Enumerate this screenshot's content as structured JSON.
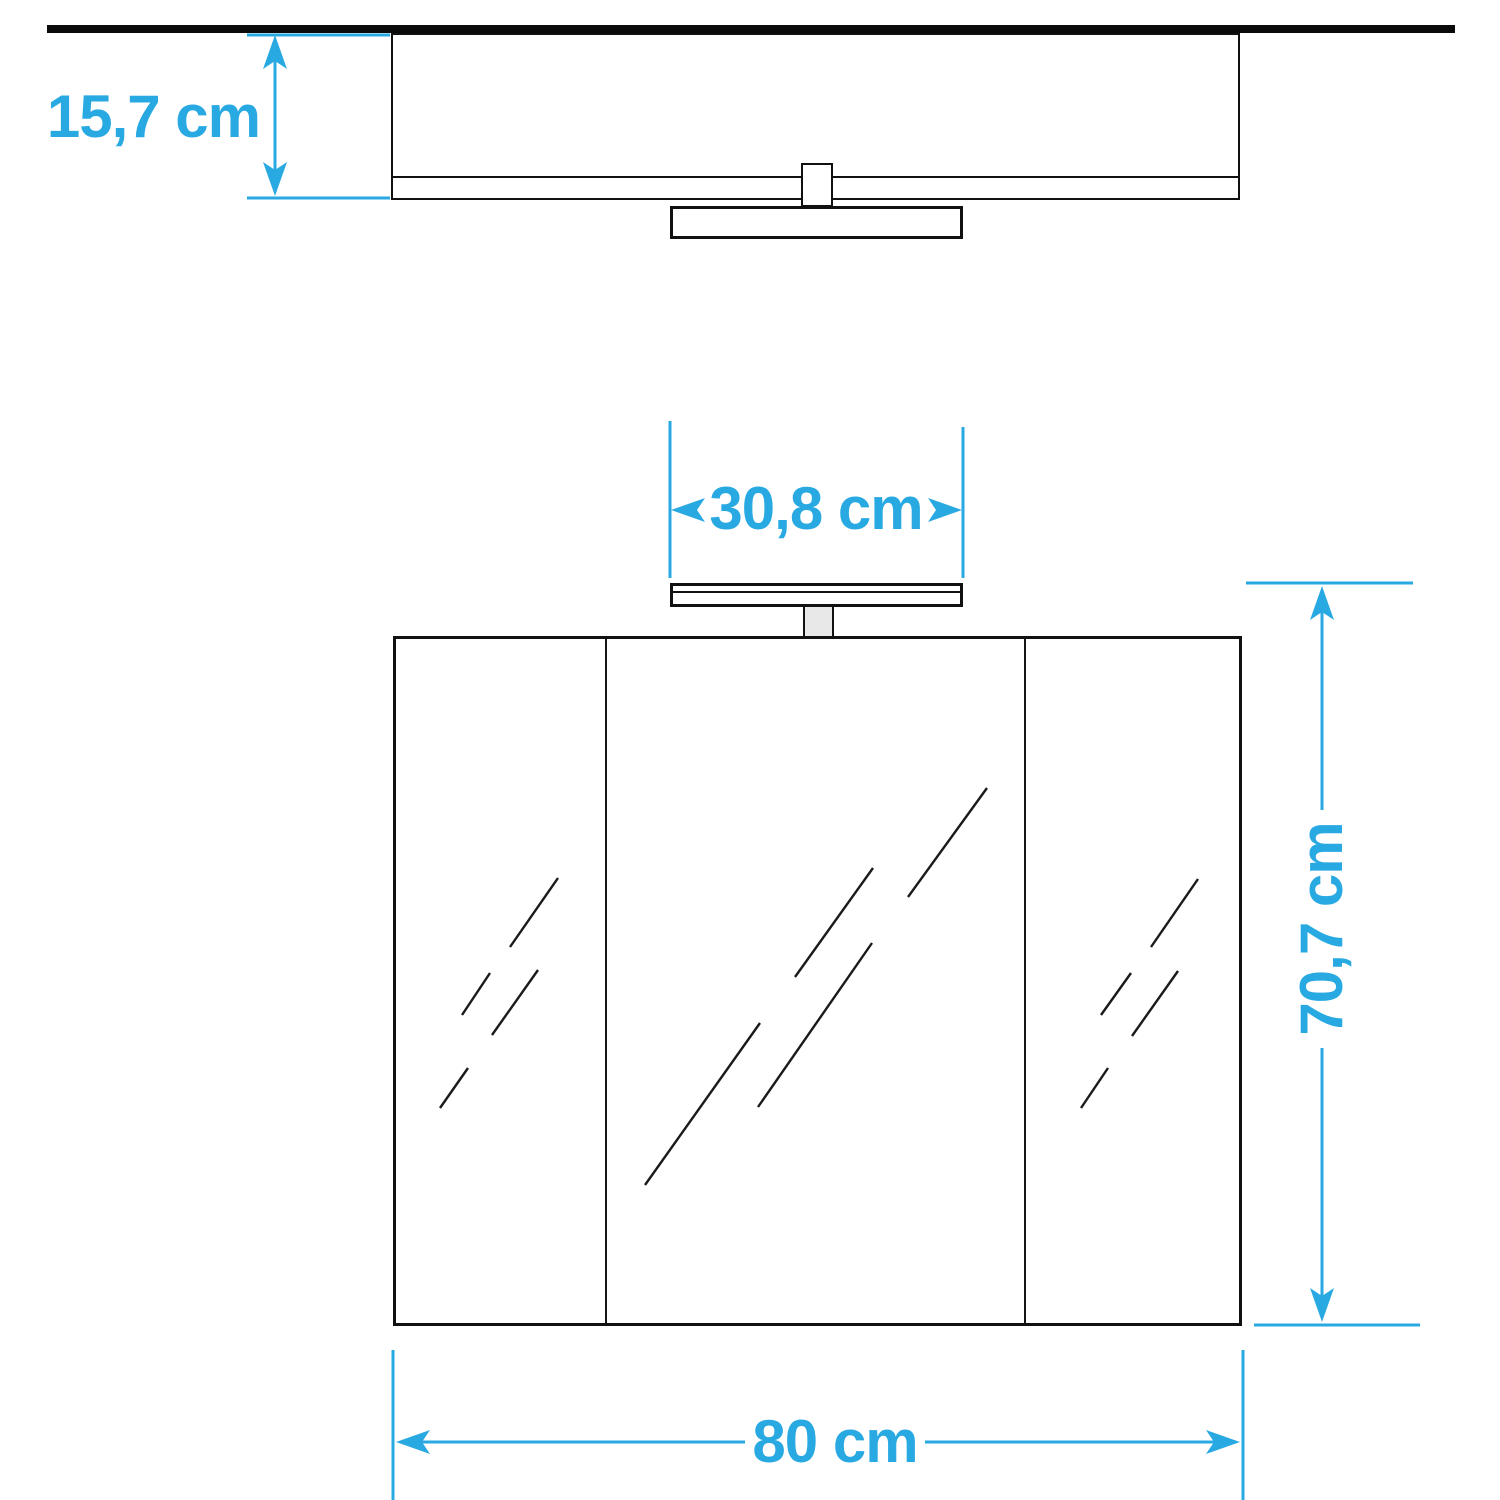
{
  "colors": {
    "dimension_blue": "#29a9e2",
    "outline_black": "#111111",
    "lamp_stem_gray": "#e8e8e8"
  },
  "diagram": {
    "type": "furniture dimension drawing",
    "subject": "3-door mirror cabinet with top lamp, top view and front view"
  },
  "dimensions": {
    "cabinet_depth": {
      "label": "15,7 cm",
      "value": 15.7,
      "unit": "cm"
    },
    "lamp_width": {
      "label": "30,8 cm",
      "value": 30.8,
      "unit": "cm"
    },
    "cabinet_height": {
      "label": "70,7 cm",
      "value": 70.7,
      "unit": "cm"
    },
    "cabinet_width": {
      "label": "80 cm",
      "value": 80,
      "unit": "cm"
    }
  }
}
